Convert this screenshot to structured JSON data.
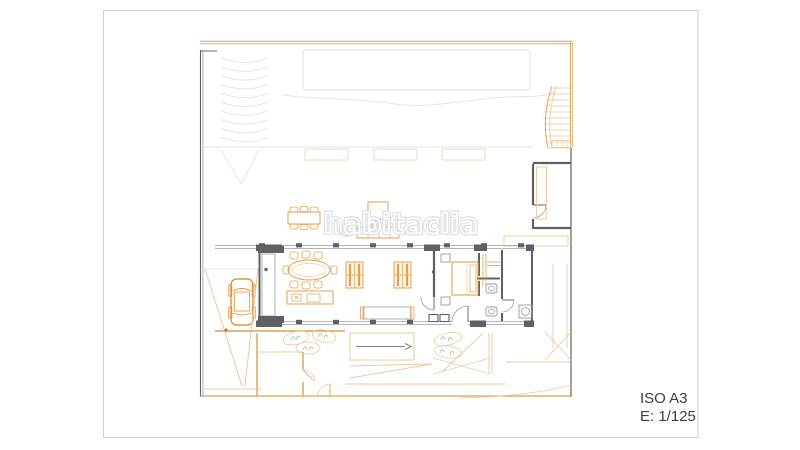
{
  "sheet": {
    "format_label": "ISO A3",
    "scale_label": "E: 1/125",
    "background": "#ffffff"
  },
  "watermark": {
    "text": "habitaclia"
  },
  "colors": {
    "plan-orange": "#dfa04f",
    "plan-orange-light": "#eec89c",
    "car-orange": "#e0953a",
    "plan-green": "#8ccc6d",
    "plan-green-light": "#bfe2a4",
    "wall-dark": "#5d6165",
    "wall-mid": "#979da2",
    "faint-gray": "#e3e5e9",
    "watermark-gray": "#e0e2e6",
    "text-dark": "#3b3e42",
    "sheet-border": "#cbced2"
  },
  "plan": {
    "type": "architectural-floor-plan",
    "features": [
      "swimming-pool",
      "curved-staircase",
      "hedge",
      "planter-boxes",
      "entry-hall-planter",
      "side-planter",
      "east-planter",
      "house-walls",
      "bookshelf",
      "dining-table",
      "kitchen-island",
      "sofas",
      "heater-bench",
      "bed",
      "wardrobe",
      "bathroom-fixtures",
      "laundry-machine",
      "outdoor-dining-table",
      "outdoor-lounge-set",
      "car",
      "driveway",
      "entry-patio",
      "shrubs",
      "interior-staircase",
      "lawn",
      "garden"
    ]
  }
}
